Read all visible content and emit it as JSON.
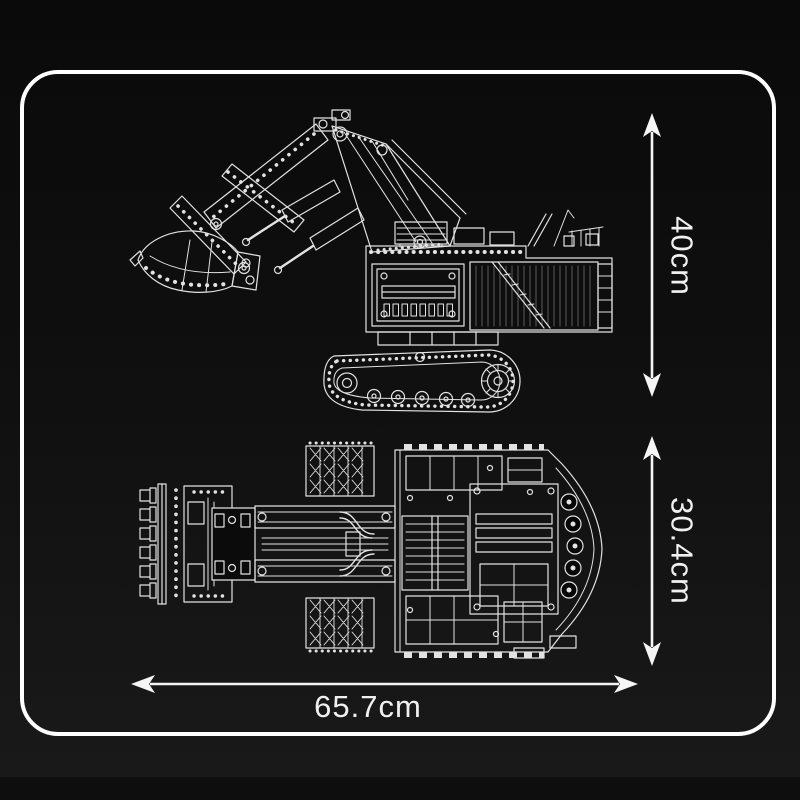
{
  "dimensions": {
    "height": {
      "label": "40cm",
      "orientation": "vertical"
    },
    "width": {
      "label": "30.4cm",
      "orientation": "vertical"
    },
    "length": {
      "label": "65.7cm",
      "orientation": "horizontal"
    }
  },
  "views": {
    "side_view_icon": "excavator-side-view-line-art",
    "top_view_icon": "excavator-top-view-line-art"
  },
  "colors": {
    "background": "#101010",
    "frame_border": "#ffffff",
    "line_art": "#e2e2e2",
    "label_text": "#f0f0f0"
  }
}
